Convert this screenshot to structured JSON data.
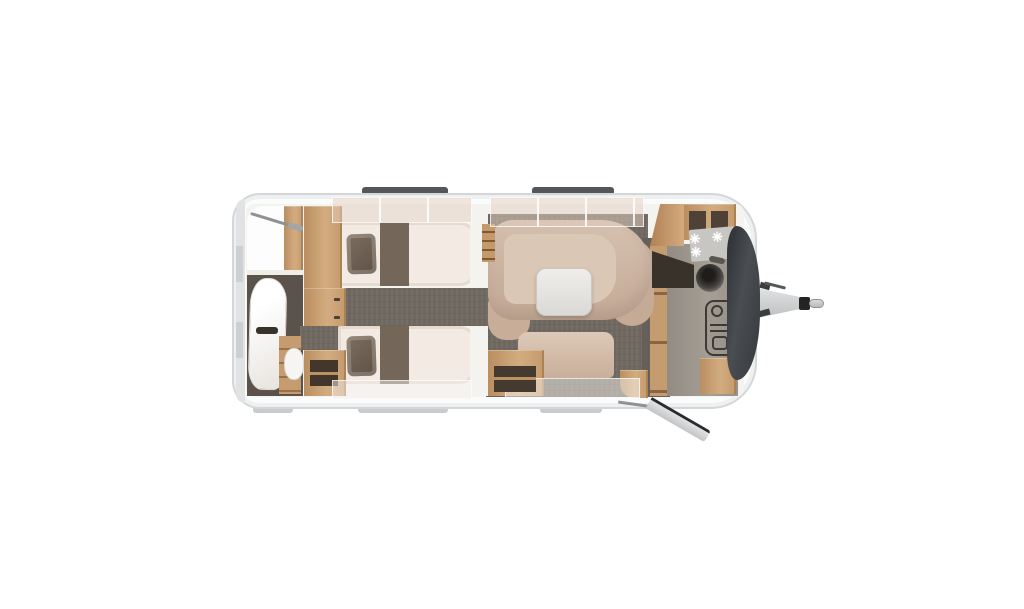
{
  "scene": {
    "type": "caravan-floorplan-top-view",
    "background": "#ffffff",
    "vehicle": "single-axle caravan with tow hitch, entry door open at front-right"
  },
  "palette": {
    "shell": "#fafbfb",
    "shell_border": "#d4d6d8",
    "interior": "#f5f3f0",
    "floor_dark": "#6f6861",
    "wood": "#c49c72",
    "wood_open_dark": "#46392d",
    "mattress": "#f3eae3",
    "pillow": "#6b5e52",
    "runner": "#746659",
    "sofa": "#ccb3a1",
    "table": "#e9e7e4",
    "counter": "#9a938b",
    "front_panel": "#3a3d41",
    "window_frame_top": "#54575a",
    "window_frame_bottom": "#c9cbcd"
  },
  "rooms": {
    "bathroom": {
      "position": "rear-left",
      "features": [
        "shower with rail",
        "washbasin vanity",
        "toilet",
        "storage shelves",
        "steps"
      ]
    },
    "bedroom": {
      "position": "mid-left",
      "beds": 2,
      "bed_type": "twin single beds",
      "features": [
        "wardrobes between beds",
        "overhead lockers",
        "pillows",
        "bed runners",
        "ladder"
      ]
    },
    "lounge": {
      "position": "mid-right",
      "features": [
        "curved U-sofa",
        "freestanding table",
        "side bench",
        "open storage cube",
        "overhead lockers"
      ]
    },
    "kitchen": {
      "position": "front-right",
      "hob_burners": "✳ ✳ ✳",
      "burner_count": 3,
      "features": [
        "3-burner hob",
        "round sink with tap",
        "heater",
        "corner shelves",
        "worktop"
      ]
    }
  },
  "exterior": {
    "hitch": "tow-hitch with coupling handle",
    "door": "entry door shown open at front-right",
    "windows_top": 2,
    "windows_bottom": 3,
    "front_cover": "dark gas-locker / front panel"
  }
}
